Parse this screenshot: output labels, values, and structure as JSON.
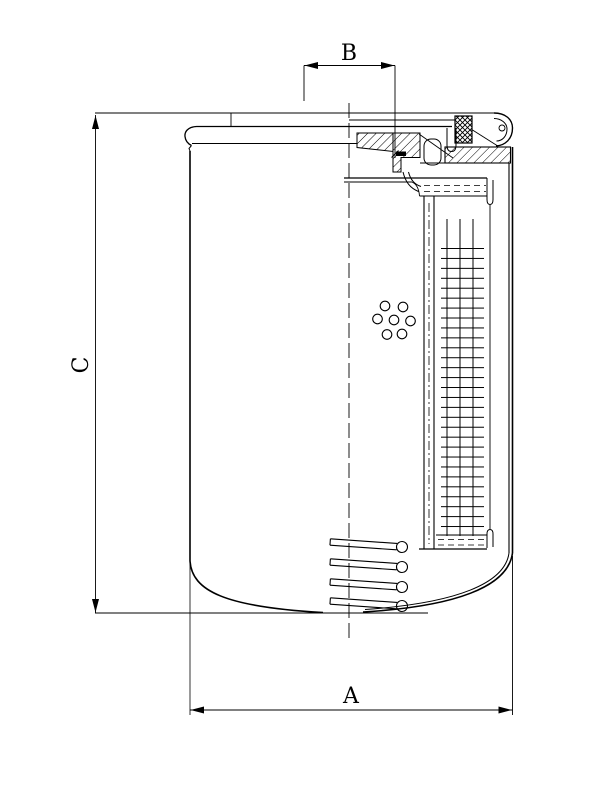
{
  "page": {
    "background": "#ffffff",
    "line_color": "#000000",
    "kind": "technical-drawing",
    "subject": "spin-on filter cartridge cross-section"
  },
  "dimensions": {
    "a": {
      "label": "A"
    },
    "b": {
      "label": "B"
    },
    "c": {
      "label": "C"
    }
  }
}
